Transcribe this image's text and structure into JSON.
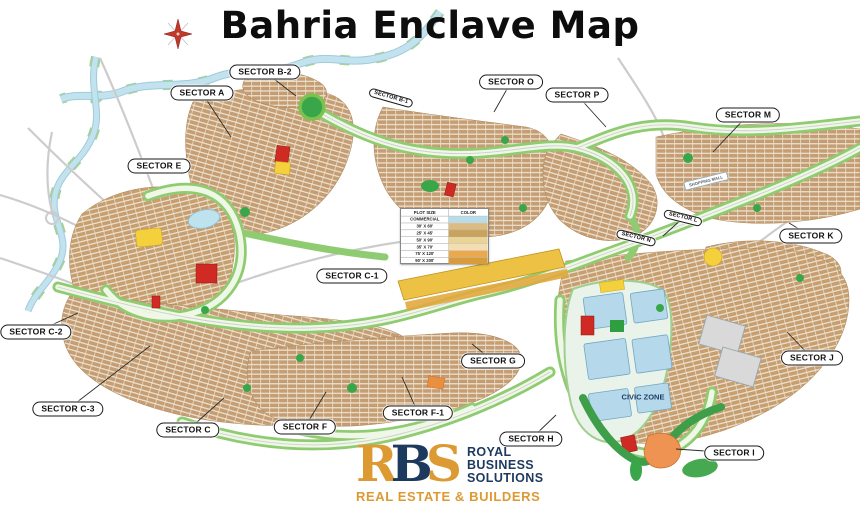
{
  "title": "Bahria Enclave Map",
  "legend": {
    "header": {
      "size": "PLOT SIZE",
      "color": "COLOR"
    },
    "rows": [
      {
        "label": "COMMERCIAL",
        "swatch": "#b9dceb"
      },
      {
        "label": "30' X 60'",
        "swatch": "#dcbc82"
      },
      {
        "label": "25' X 45'",
        "swatch": "#c9a35e"
      },
      {
        "label": "50' X 90'",
        "swatch": "#e9d493"
      },
      {
        "label": "35' X 70'",
        "swatch": "#f2ddb5"
      },
      {
        "label": "75' X 120'",
        "swatch": "#eaa94e"
      },
      {
        "label": "90' X 200'",
        "swatch": "#d69c3d"
      }
    ]
  },
  "sectors": [
    {
      "label": "SECTOR B-2",
      "x": 265,
      "y": 72,
      "leader": [
        296,
        96
      ]
    },
    {
      "label": "SECTOR A",
      "x": 202,
      "y": 93,
      "leader": [
        231,
        137
      ]
    },
    {
      "label": "SECTOR O",
      "x": 511,
      "y": 82,
      "leader": [
        494,
        112
      ]
    },
    {
      "label": "SECTOR P",
      "x": 577,
      "y": 95,
      "leader": [
        606,
        127
      ]
    },
    {
      "label": "SECTOR B-1",
      "x": 391,
      "y": 98,
      "rot": 16,
      "small": true
    },
    {
      "label": "SECTOR M",
      "x": 748,
      "y": 115,
      "leader": [
        713,
        152
      ]
    },
    {
      "label": "SECTOR E",
      "x": 159,
      "y": 166
    },
    {
      "label": "SECTOR L",
      "x": 683,
      "y": 218,
      "rot": 14,
      "small": true,
      "leader": [
        663,
        236
      ]
    },
    {
      "label": "SECTOR N",
      "x": 636,
      "y": 238,
      "rot": 14,
      "small": true
    },
    {
      "label": "SECTOR K",
      "x": 811,
      "y": 236,
      "leader": [
        789,
        223
      ]
    },
    {
      "label": "SECTOR C-1",
      "x": 352,
      "y": 276
    },
    {
      "label": "SECTOR C-2",
      "x": 36,
      "y": 332,
      "leader": [
        78,
        313
      ]
    },
    {
      "label": "SECTOR C-3",
      "x": 68,
      "y": 409,
      "leader": [
        150,
        346
      ]
    },
    {
      "label": "SECTOR C",
      "x": 188,
      "y": 430,
      "leader": [
        224,
        398
      ]
    },
    {
      "label": "SECTOR F",
      "x": 305,
      "y": 427,
      "leader": [
        326,
        392
      ]
    },
    {
      "label": "SECTOR F-1",
      "x": 418,
      "y": 413,
      "leader": [
        402,
        377
      ]
    },
    {
      "label": "SECTOR G",
      "x": 493,
      "y": 361,
      "leader": [
        472,
        344
      ]
    },
    {
      "label": "SECTOR H",
      "x": 531,
      "y": 439,
      "leader": [
        556,
        415
      ]
    },
    {
      "label": "SECTOR I",
      "x": 734,
      "y": 453,
      "leader": [
        676,
        449
      ]
    },
    {
      "label": "SECTOR J",
      "x": 812,
      "y": 358,
      "leader": [
        787,
        332
      ]
    }
  ],
  "map_texts": [
    {
      "label": "CIVIC ZONE",
      "x": 643,
      "y": 397,
      "size": 7.5,
      "rot": 0,
      "color": "#1c3e66",
      "boxed": false
    },
    {
      "label": "SHOPPING MALL",
      "x": 706,
      "y": 181,
      "size": 4.2,
      "rot": -14,
      "color": "#55636e",
      "boxed": true
    }
  ],
  "logo": {
    "monogram": [
      {
        "char": "R",
        "color": "#dd9a33"
      },
      {
        "char": "B",
        "color": "#1d3a5e"
      },
      {
        "char": "S",
        "color": "#dd9a33"
      }
    ],
    "name_lines": [
      "ROYAL",
      "BUSINESS",
      "SOLUTIONS"
    ],
    "name_color": "#1d3a5e",
    "tagline": "REAL ESTATE & BUILDERS",
    "tagline_color": "#dd9a33"
  },
  "colors": {
    "housing": "#c79e73",
    "housing_bg": "#ecdcc4",
    "road_green": "#8fcb70",
    "park_green": "#3aa64a",
    "river_blue": "#c2e2ee",
    "commercial_strip": "#edc244",
    "civic_block_blue": "#b5d9ea",
    "landmark_red": "#cf2b24",
    "landmark_yellow": "#f3d03c",
    "landmark_orange": "#ef9352",
    "compass_red": "#c0392b"
  }
}
